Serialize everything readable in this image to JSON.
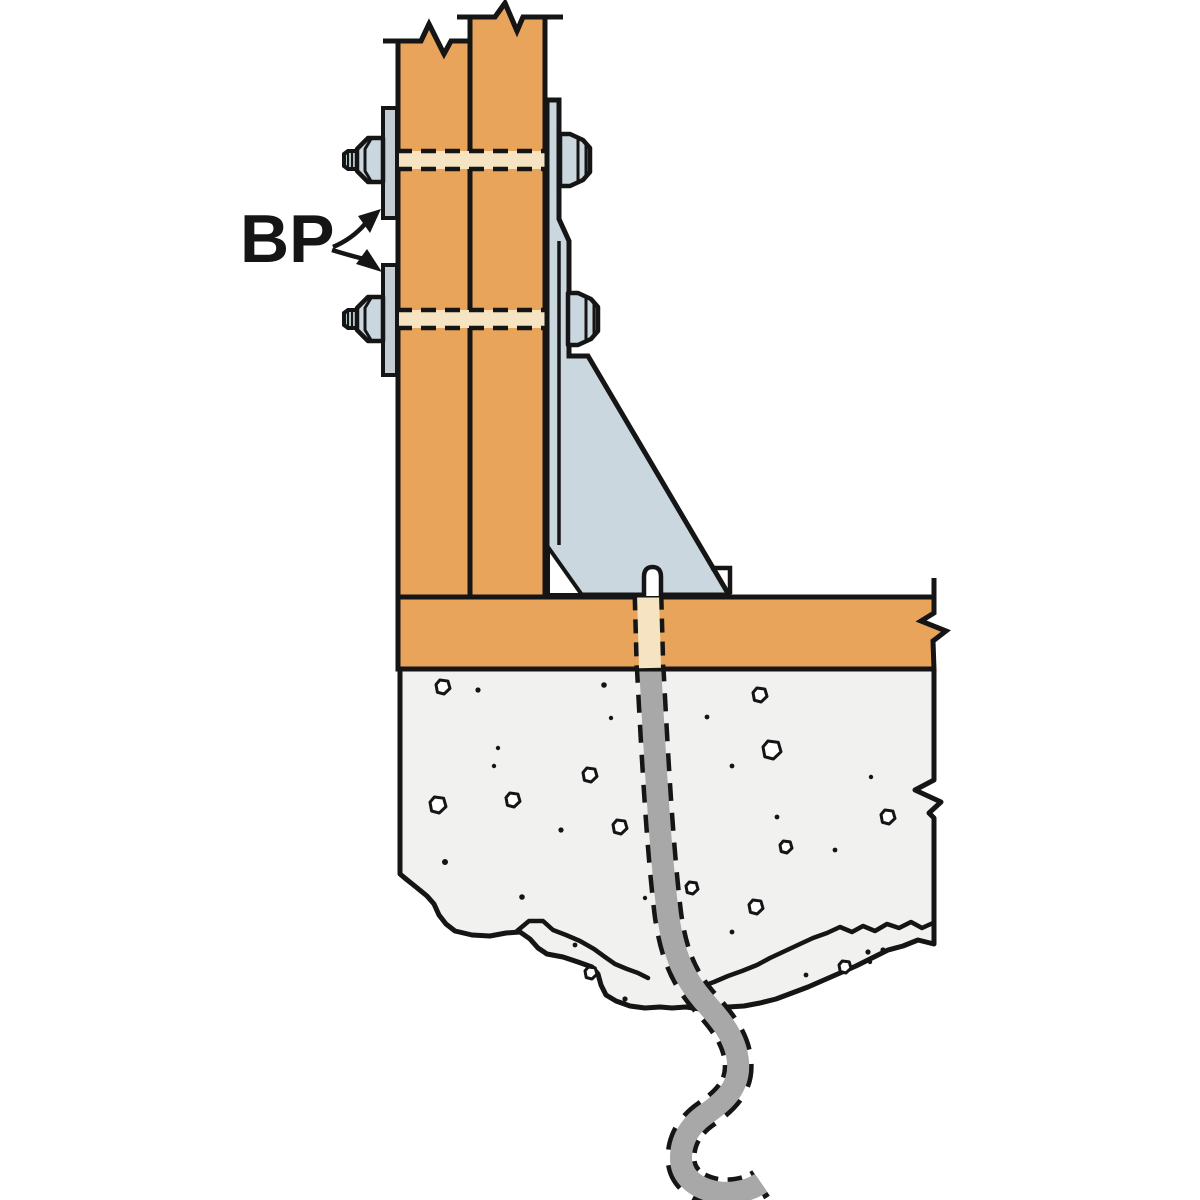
{
  "diagram": {
    "label": "BP",
    "label_meaning": "bearing-plate-callout",
    "colors": {
      "wood": "#E9A45B",
      "woodHole": "#F5E3C2",
      "steel": "#CBD7DF",
      "plate": "#C5CCD2",
      "concrete": "#F1F1F0",
      "rod": "#A8A8A8",
      "line": "#151515",
      "white": "#FFFFFF"
    },
    "aggregates": [
      {
        "type": "pebble",
        "x": 443,
        "y": 687,
        "s": 7
      },
      {
        "type": "pebble",
        "x": 760,
        "y": 695,
        "s": 7
      },
      {
        "type": "pebble",
        "x": 772,
        "y": 750,
        "s": 9
      },
      {
        "type": "pebble",
        "x": 590,
        "y": 775,
        "s": 7
      },
      {
        "type": "pebble",
        "x": 438,
        "y": 805,
        "s": 8
      },
      {
        "type": "pebble",
        "x": 513,
        "y": 800,
        "s": 7
      },
      {
        "type": "pebble",
        "x": 620,
        "y": 827,
        "s": 7
      },
      {
        "type": "pebble",
        "x": 888,
        "y": 817,
        "s": 7
      },
      {
        "type": "pebble",
        "x": 786,
        "y": 847,
        "s": 6
      },
      {
        "type": "pebble",
        "x": 692,
        "y": 888,
        "s": 6
      },
      {
        "type": "pebble",
        "x": 756,
        "y": 907,
        "s": 7
      },
      {
        "type": "pebble",
        "x": 591,
        "y": 973,
        "s": 6
      },
      {
        "type": "pebble",
        "x": 845,
        "y": 967,
        "s": 6
      },
      {
        "type": "dot",
        "x": 478,
        "y": 690,
        "s": 2.6
      },
      {
        "type": "dot",
        "x": 604,
        "y": 685,
        "s": 2.8
      },
      {
        "type": "dot",
        "x": 611,
        "y": 718,
        "s": 2.2
      },
      {
        "type": "dot",
        "x": 707,
        "y": 717,
        "s": 2.4
      },
      {
        "type": "dot",
        "x": 498,
        "y": 748,
        "s": 2.2
      },
      {
        "type": "dot",
        "x": 494,
        "y": 766,
        "s": 2.2
      },
      {
        "type": "dot",
        "x": 732,
        "y": 766,
        "s": 2.4
      },
      {
        "type": "dot",
        "x": 871,
        "y": 777,
        "s": 2.2
      },
      {
        "type": "dot",
        "x": 777,
        "y": 817,
        "s": 2.4
      },
      {
        "type": "dot",
        "x": 561,
        "y": 830,
        "s": 2.6
      },
      {
        "type": "dot",
        "x": 835,
        "y": 850,
        "s": 2.4
      },
      {
        "type": "dot",
        "x": 445,
        "y": 862,
        "s": 3.0
      },
      {
        "type": "dot",
        "x": 522,
        "y": 897,
        "s": 2.8
      },
      {
        "type": "dot",
        "x": 645,
        "y": 898,
        "s": 2.2
      },
      {
        "type": "dot",
        "x": 575,
        "y": 945,
        "s": 2.4
      },
      {
        "type": "dot",
        "x": 732,
        "y": 932,
        "s": 2.4
      },
      {
        "type": "dot",
        "x": 625,
        "y": 999,
        "s": 2.6
      },
      {
        "type": "dot",
        "x": 868,
        "y": 952,
        "s": 2.6
      },
      {
        "type": "dot",
        "x": 883,
        "y": 950,
        "s": 2.6
      },
      {
        "type": "dot",
        "x": 870,
        "y": 962,
        "s": 2.2
      },
      {
        "type": "dot",
        "x": 806,
        "y": 975,
        "s": 2.4
      }
    ]
  }
}
